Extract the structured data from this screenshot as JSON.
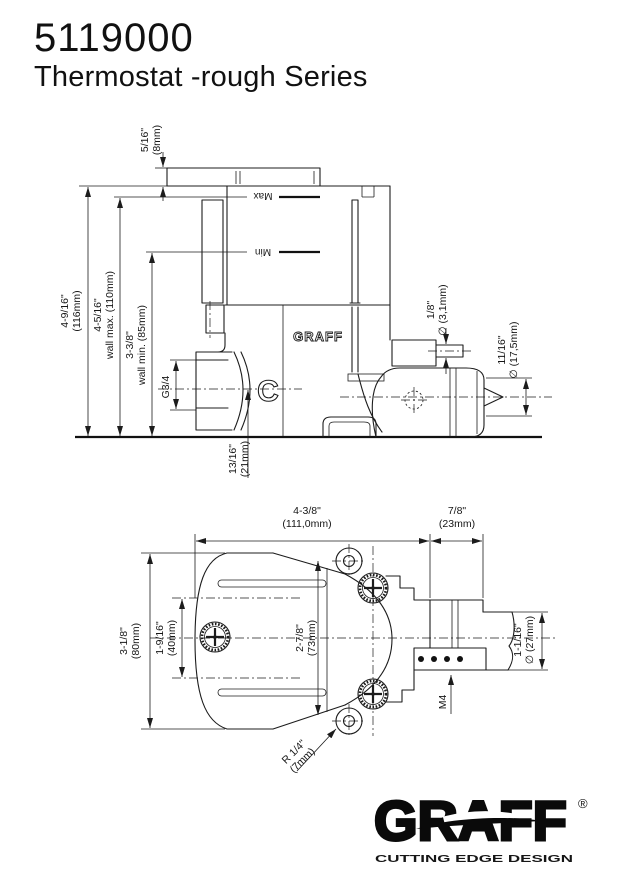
{
  "header": {
    "model": "5119000",
    "series": "Thermostat -rough Series"
  },
  "side_view": {
    "brand_mark": "GRAFF",
    "letter_mark": "C",
    "max_label": "Max",
    "min_label": "Min",
    "dims": {
      "cap": {
        "l1": "5/16\"",
        "l2": "(8mm)"
      },
      "total": {
        "l1": "4-9/16\"",
        "l2": "(116mm)"
      },
      "wall_max": {
        "l1": "4-5/16\"",
        "l2": "wall max. (110mm)"
      },
      "wall_min": {
        "l1": "3-3/8\"",
        "l2": "wall min. (85mm)"
      },
      "port": "G3/4",
      "offset": {
        "l1": "13/16\"",
        "l2": "(21mm)"
      },
      "hole": {
        "l1": "1/8\"",
        "l2": "∅ (3,1mm)"
      },
      "cartridge": {
        "l1": "11/16\"",
        "l2": "∅ (17,5mm)"
      }
    }
  },
  "front_view": {
    "dims": {
      "width": {
        "l1": "4-3/8\"",
        "l2": "(111,0mm)"
      },
      "outlet": {
        "l1": "7/8\"",
        "l2": "(23mm)"
      },
      "height": {
        "l1": "3-1/8\"",
        "l2": "(80mm)"
      },
      "span": {
        "l1": "1-9/16\"",
        "l2": "(40mm)"
      },
      "depth": {
        "l1": "2-7/8\"",
        "l2": "(73mm)"
      },
      "diameter": {
        "l1": "1-1/16\"",
        "l2": "∅ (27mm)"
      },
      "thread": "M4",
      "radius": {
        "l1": "R 1/4\"",
        "l2": "(7mm)"
      }
    }
  },
  "logo": {
    "name": "GRAFF",
    "reg": "®",
    "tagline": "CUTTING EDGE DESIGN"
  }
}
